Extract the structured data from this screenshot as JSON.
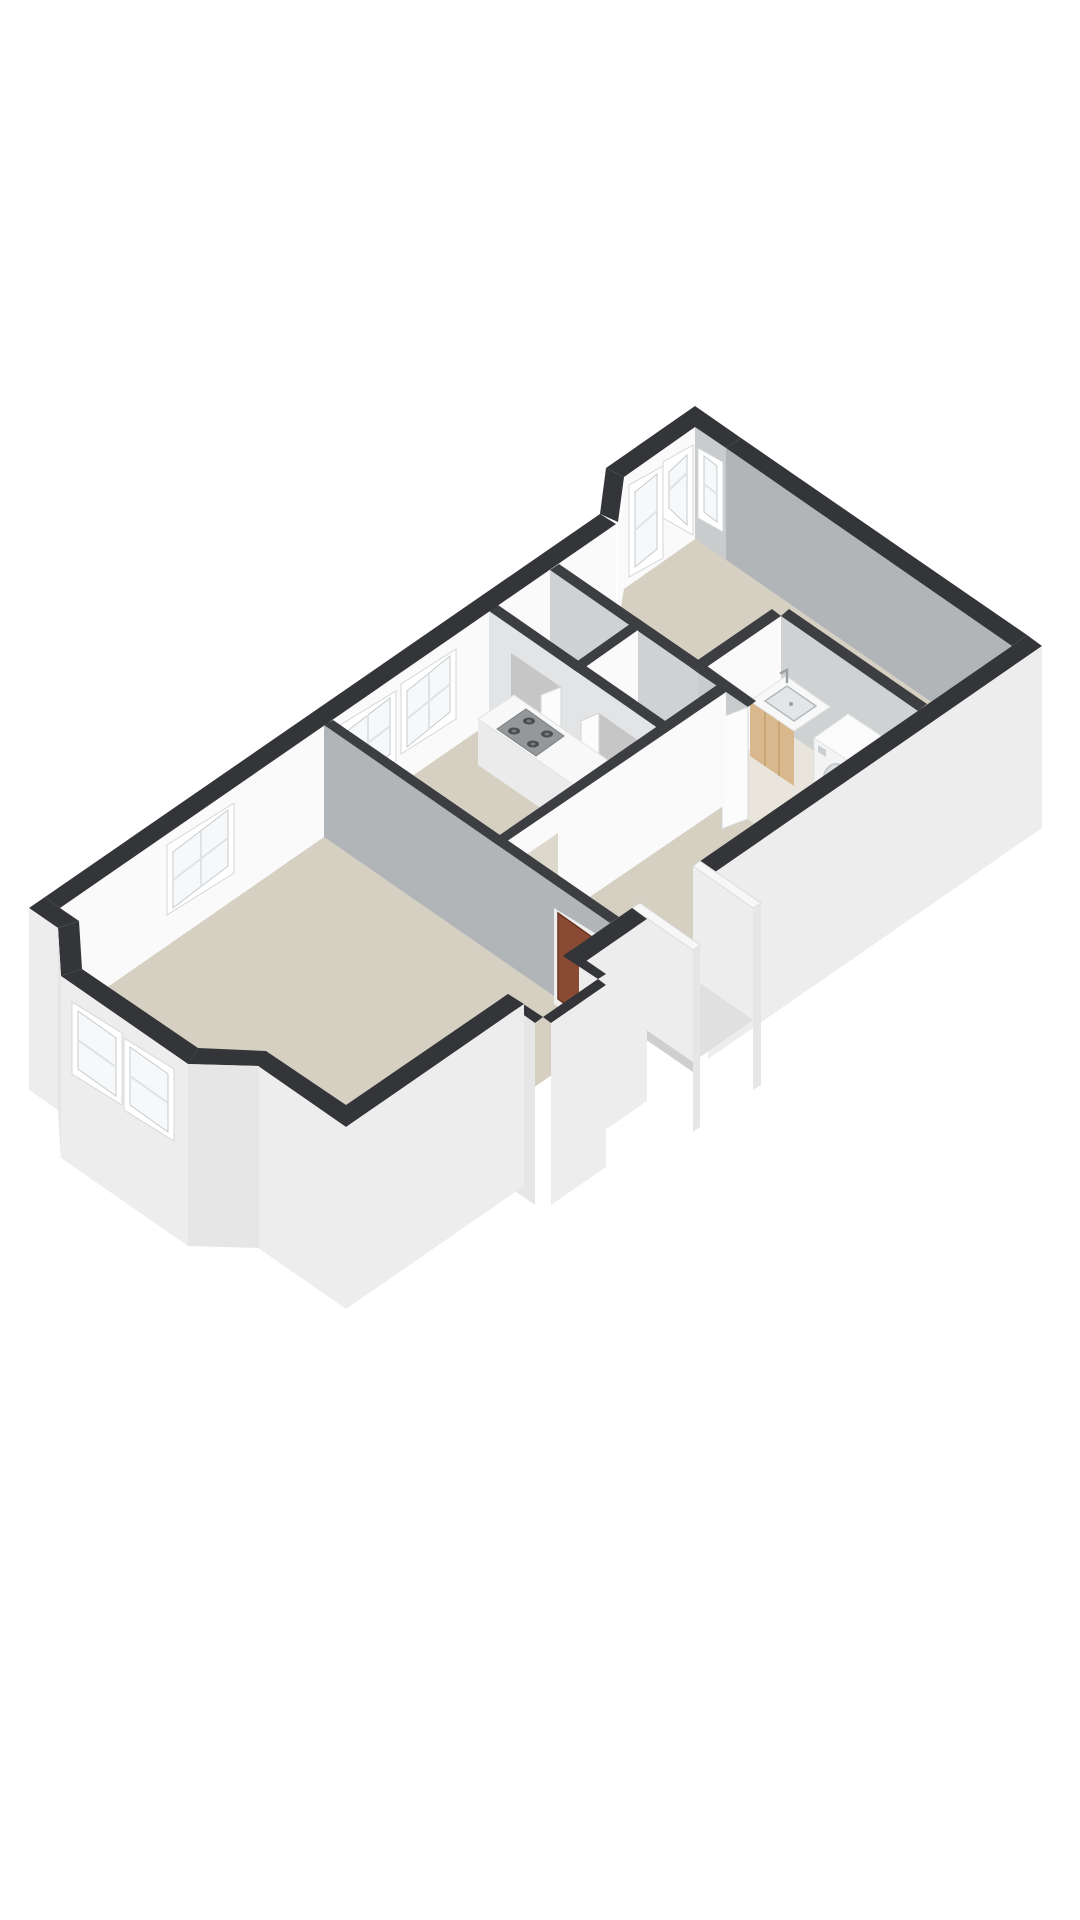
{
  "scene": {
    "type": "isometric-3d-floorplan",
    "description": "3D cutaway floor plan of an apartment rendered isometrically on a white background, no text labels",
    "background": "#ffffff"
  },
  "colors": {
    "bg": "#ffffff",
    "wall-top": "#333538",
    "wall-top-int": "#3c3e41",
    "face-bright": "#fafafa",
    "face-dark": "#b2b5b7",
    "face-mid": "#c9cccd",
    "face-light": "#cfd2d3",
    "face-light2": "#e2e4e5",
    "face-ext": "#ededed",
    "face-ext2": "#e6e6e6",
    "floor": "#d6d0c3",
    "floor-bath": "#e9e5dc",
    "cell-dark": "#c6c6c6",
    "glass": "#f6f8f9",
    "frame": "#ffffff",
    "wood": "#d8b88c",
    "wood-dark": "#c2a172",
    "door-brown": "#8a4a33",
    "door-brown-edge": "#6b3522",
    "counter-top": "#f8f8f8",
    "counter-front": "#ebebeb",
    "cooktop": "#94989a",
    "burner": "#4a4e50",
    "metal": "#9aa0a3",
    "appliance": "#f4f4f4",
    "porch": "#e0e0e0"
  },
  "rooms": [
    {
      "name": "living-room",
      "features": [
        "bay-window",
        "chimney-breast"
      ]
    },
    {
      "name": "kitchen",
      "features": [
        "two-sash-windows",
        "counter",
        "cooktop",
        "sink"
      ]
    },
    {
      "name": "storage-closets",
      "features": [
        "two-doors"
      ]
    },
    {
      "name": "hallway",
      "features": [
        "front-door",
        "entrance-porch"
      ]
    },
    {
      "name": "bathroom",
      "features": [
        "wooden-vanity-sink",
        "washing-machine",
        "door"
      ]
    },
    {
      "name": "bedroom",
      "features": [
        "bay-window-three-panes"
      ]
    }
  ],
  "fixtures": [
    {
      "name": "kitchen-counter"
    },
    {
      "name": "gas-cooktop-4-burners"
    },
    {
      "name": "kitchen-sink-with-faucet"
    },
    {
      "name": "bathroom-vanity-wood-cabinet"
    },
    {
      "name": "bathroom-basin-with-faucet"
    },
    {
      "name": "washing-machine-front-loader"
    },
    {
      "name": "front-door-brown"
    },
    {
      "name": "interior-white-doors",
      "count": 4
    }
  ]
}
